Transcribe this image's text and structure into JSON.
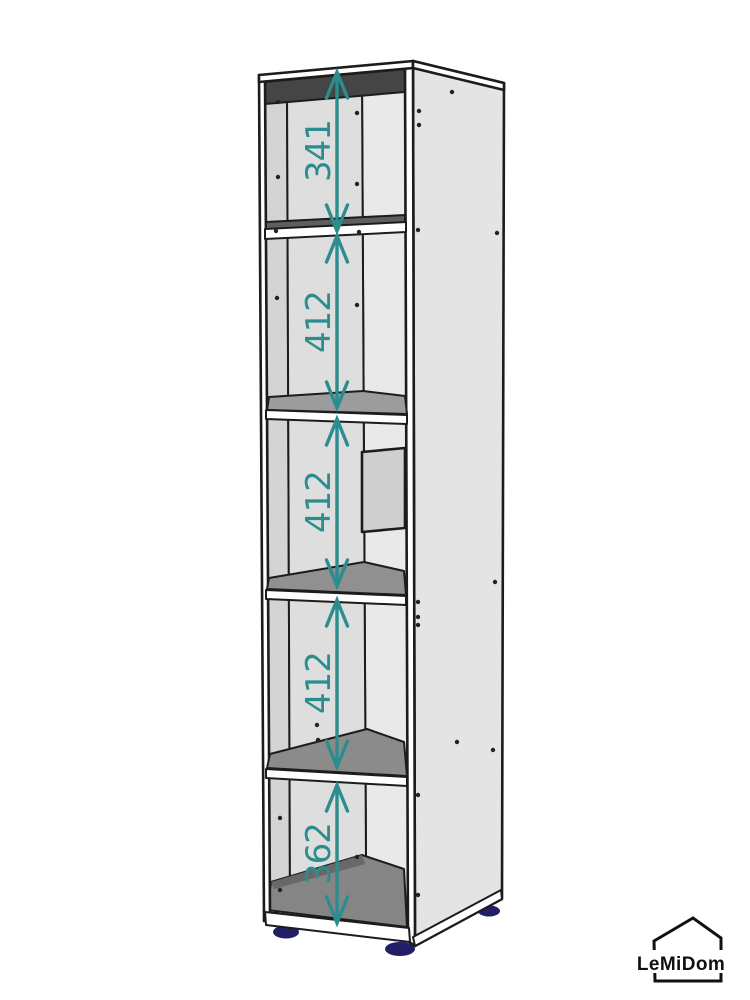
{
  "page": {
    "background": "#ffffff"
  },
  "product": {
    "type": "tall-open-shelving-unit",
    "compartments": 5
  },
  "dimensions": {
    "color": "#2b8d8d",
    "items": [
      {
        "label": "341",
        "x": 337,
        "y1": 72,
        "y2": 231,
        "label_x": 330,
        "label_y": 151
      },
      {
        "label": "412",
        "x": 337,
        "y1": 236,
        "y2": 408,
        "label_x": 330,
        "label_y": 322
      },
      {
        "label": "412",
        "x": 337,
        "y1": 419,
        "y2": 586,
        "label_x": 330,
        "label_y": 502
      },
      {
        "label": "412",
        "x": 337,
        "y1": 600,
        "y2": 767,
        "label_x": 330,
        "label_y": 683
      },
      {
        "label": "362",
        "x": 337,
        "y1": 785,
        "y2": 923,
        "label_x": 330,
        "label_y": 854
      }
    ]
  },
  "holes": [
    [
      278,
      102
    ],
    [
      357,
      113
    ],
    [
      419,
      111
    ],
    [
      419,
      125
    ],
    [
      278,
      177
    ],
    [
      357,
      184
    ],
    [
      276,
      231
    ],
    [
      359,
      232
    ],
    [
      418,
      230
    ],
    [
      497,
      233
    ],
    [
      277,
      298
    ],
    [
      357,
      305
    ],
    [
      495,
      582
    ],
    [
      418,
      602
    ],
    [
      418,
      617
    ],
    [
      418,
      625
    ],
    [
      317,
      725
    ],
    [
      318,
      740
    ],
    [
      457,
      742
    ],
    [
      493,
      750
    ],
    [
      280,
      818
    ],
    [
      357,
      857
    ],
    [
      280,
      890
    ],
    [
      418,
      795
    ],
    [
      418,
      895
    ],
    [
      452,
      92
    ]
  ],
  "colors": {
    "dimension_teal": "#2b8d8d",
    "outline": "#1c1c1c",
    "side_panel": "#e4e4e4",
    "back_wall": "#dedede",
    "shelf_top": "#8f8f8f",
    "ceiling_shadow": "#454545",
    "feet_navy": "#221f66"
  },
  "logo": {
    "text": "LeMiDom"
  }
}
